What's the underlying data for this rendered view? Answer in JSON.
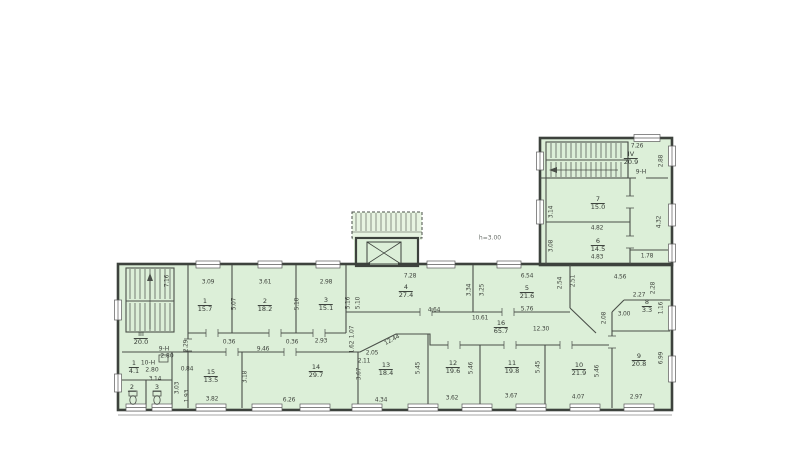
{
  "plan": {
    "height_note": "h=3.00",
    "units": {
      "unit_9n_wing": "9-Н",
      "unit_9n_left": "9-Н",
      "unit_9n_left_value": "2.80",
      "unit_10n_left": "10-Н",
      "unit_10n_left_value": "2.80"
    }
  },
  "rooms": {
    "r1": {
      "number": "1",
      "area": "15.7"
    },
    "r2": {
      "number": "2",
      "area": "18.2"
    },
    "r3": {
      "number": "3",
      "area": "15.1"
    },
    "r4": {
      "number": "4",
      "area": "27.4"
    },
    "r5": {
      "number": "5",
      "area": "21.6"
    },
    "r6": {
      "number": "6",
      "area": "14.5"
    },
    "r7": {
      "number": "7",
      "area": "15.0"
    },
    "r8": {
      "number": "8",
      "area": "3.3"
    },
    "r9": {
      "number": "9",
      "area": "20.8"
    },
    "r10": {
      "number": "10",
      "area": "21.9"
    },
    "r11": {
      "number": "11",
      "area": "19.8"
    },
    "r12": {
      "number": "12",
      "area": "19.6"
    },
    "r13": {
      "number": "13",
      "area": "18.4"
    },
    "r14": {
      "number": "14",
      "area": "29.7"
    },
    "r15": {
      "number": "15",
      "area": "13.5"
    },
    "r16": {
      "number": "16",
      "area": "65.7"
    },
    "r1s": {
      "number": "1",
      "area": "4.1"
    },
    "wc2": {
      "number": "2"
    },
    "wc3": {
      "number": "3"
    },
    "s3": {
      "number": "III",
      "area": "20.0"
    },
    "s4": {
      "number": "IV",
      "area": "20.9"
    }
  },
  "dims": {
    "d0": "7.26",
    "d1": "2.88",
    "d2": "3.14",
    "d3": "4.82",
    "d4": "3.08",
    "d5": "4.83",
    "d6": "4.32",
    "d7": "1.78",
    "d8": "4.56",
    "d9": "2.28",
    "d10": "2.27",
    "d11": "3.00",
    "d12": "1.16",
    "d13": "2.08",
    "d14": "2.54",
    "d15": "2.51",
    "d16": "7.28",
    "d17": "6.54",
    "d18": "4.64",
    "d19": "5.76",
    "d20": "10.61",
    "d21": "12.30",
    "d22": "3.09",
    "d23": "3.61",
    "d24": "2.98",
    "d25": "5.07",
    "d26": "5.10",
    "d27": "5.16",
    "d28": "5.10",
    "d29": "3.34",
    "d30": "3.25",
    "d31": "0.36",
    "d32": "0.36",
    "d33": "2.93",
    "d34": "1.07",
    "d35": "1.62",
    "d36": "9.46",
    "d37": "12.44",
    "d38": "2.05",
    "d39": "2.11",
    "d40": "3.67",
    "d41": "3.18",
    "d42": "0.84",
    "d43": "3.14",
    "d44": "2.29",
    "d45": "7.16",
    "d46": "3.03",
    "d47": "1.93",
    "d48": "3.82",
    "d49": "6.26",
    "d50": "4.34",
    "d51": "3.62",
    "d52": "3.67",
    "d53": "4.07",
    "d54": "2.97",
    "d55": "5.46",
    "d56": "5.45",
    "d57": "5.46",
    "d58": "6.99",
    "d59": "5.45"
  },
  "colors": {
    "floor": "#dcefd8",
    "wall": "#3d423d"
  }
}
